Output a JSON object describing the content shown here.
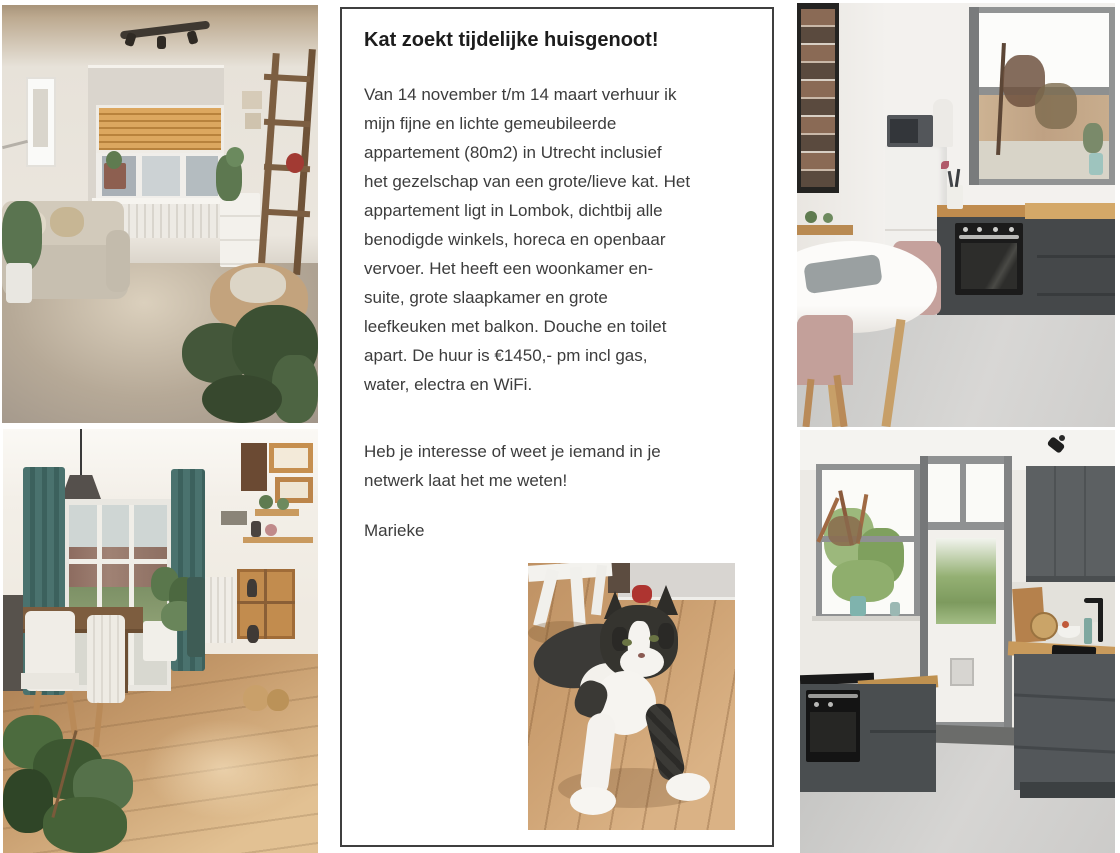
{
  "flyer": {
    "title": "Kat zoekt tijdelijke huisgenoot!",
    "body": "Van 14 november t/m 14 maart verhuur ik\nmijn fijne en lichte gemeubileerde\nappartement (80m2) in Utrecht inclusief\nhet gezelschap van een grote/lieve kat. Het\nappartement ligt in Lombok, dichtbij alle\nbenodigde winkels, horeca en openbaar\nvervoer. Het heeft een woonkamer en-\nsuite, grote slaapkamer en grote\nleefkeuken met balkon. Douche en toilet\napart. De huur is €1450,- pm incl gas,\nwater, electra en WiFi.",
    "cta": "Heb je interesse of weet je iemand in je\nnetwerk laat het me weten!",
    "signature": "Marieke"
  },
  "photos": {
    "living_room": "Woonkamer met erker, jaloezieen, bank en planten",
    "dining_room": "Eetkamer met groene gordijnen, houten tafel en wandplanken",
    "kitchen_table": "Leefkeuken met koelkast, oven en ronde witte tafel",
    "kitchen_door": "Keuken met balkondeur, kattenluik en antraciet keukenblok",
    "cat": "Grote zwart-witte kat liggend op houten vloer"
  },
  "colors": {
    "box_border": "#3f3f3f",
    "title_text": "#1c1c1c",
    "body_text": "#3c3c3c"
  }
}
